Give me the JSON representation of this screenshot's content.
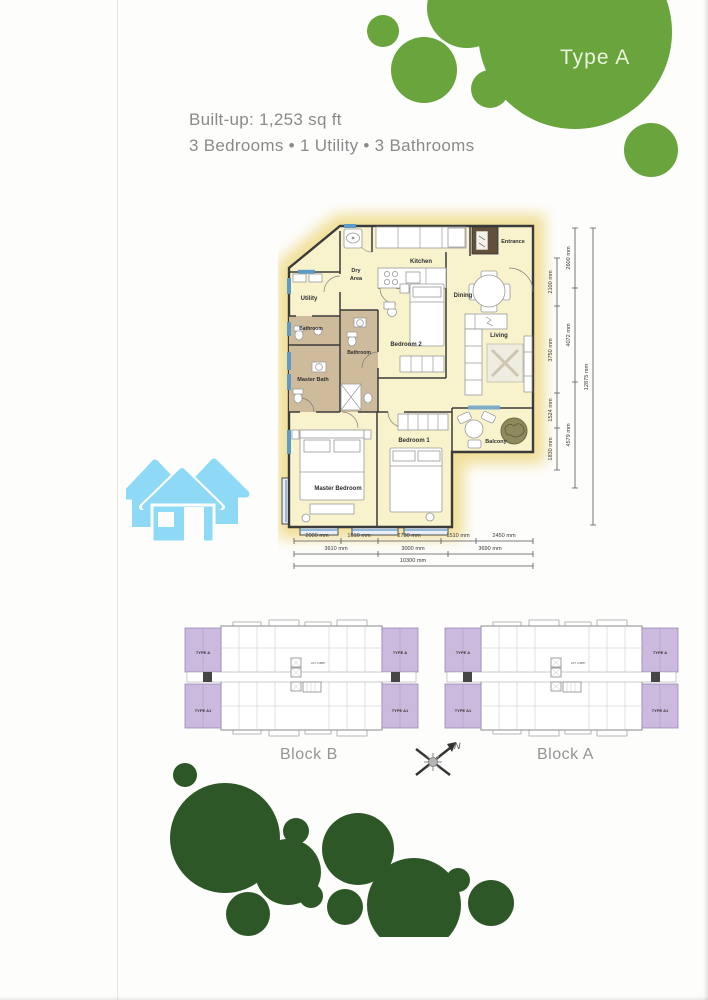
{
  "header": {
    "type_label": "Type A",
    "built_up": "Built-up: 1,253 sq ft",
    "features": "3 Bedrooms • 1 Utility • 3 Bathrooms"
  },
  "floorplan": {
    "rooms": {
      "entrance": "Entrance",
      "kitchen": "Kitchen",
      "dry_line1": "Dry",
      "dry_line2": "Area",
      "dining": "Dining",
      "utility": "Utility",
      "bathroom_a": "Bathroom",
      "bathroom_b": "Bathroom",
      "master_bath": "Master Bath",
      "bedroom_2": "Bedroom 2",
      "living": "Living",
      "bedroom_1": "Bedroom 1",
      "master_bedroom": "Master Bedroom",
      "balcony": "Balcony"
    },
    "dims": {
      "bottom_row1": [
        "2000 mm",
        "1610 mm",
        "2730 mm",
        "1510 mm",
        "2450 mm"
      ],
      "bottom_row2": [
        "3610 mm",
        "3000 mm",
        "3690 mm"
      ],
      "bottom_total": "10300 mm",
      "right_inner": [
        "2100 mm",
        "3750 mm",
        "1524 mm",
        "1830 mm"
      ],
      "right_mid": [
        "2600 mm",
        "4072 mm",
        "4579 mm"
      ],
      "right_total": "12875 mm"
    }
  },
  "blocks": {
    "block_b": "Block B",
    "block_a": "Block A",
    "type_a": "TYPE A",
    "type_a1": "TYPE A1",
    "lift_lobby": "LIFT LOBBY",
    "compass_north": "N"
  },
  "colors": {
    "brand_green": "#69a43c",
    "dark_green": "#2e5727",
    "logo_blue": "#8edaf6",
    "plan_floor": "#f8f3cd",
    "bath_floor": "#cdbb9b",
    "unit_purple": "#ccb9de",
    "wall": "#3b3b3b",
    "text_gray": "#8a8a8a"
  }
}
